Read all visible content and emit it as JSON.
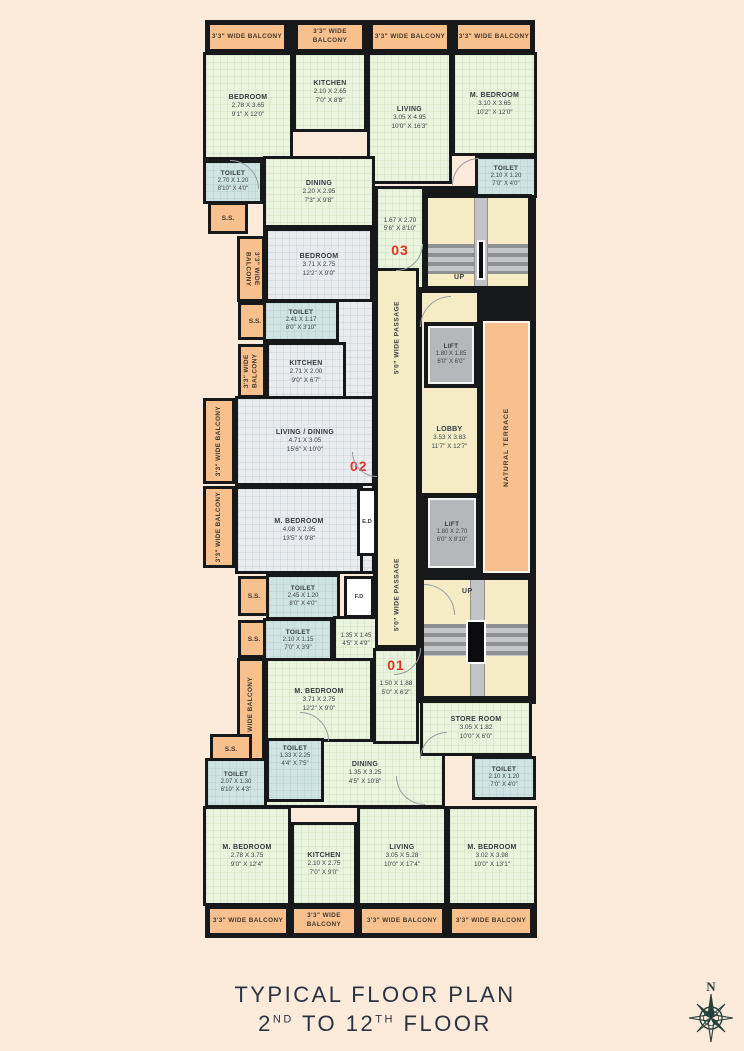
{
  "title": {
    "line1": "TYPICAL FLOOR PLAN",
    "l2n1": "2",
    "l2s1": "ND",
    "l2mid": " TO ",
    "l2n2": "12",
    "l2s2": "TH",
    "l2end": " FLOOR"
  },
  "compass": {
    "north": "N"
  },
  "colors": {
    "background": "#fceadb",
    "room_green": "#eaf3dd",
    "room_gray": "#e9ecef",
    "toilet_blue": "#cfe3e3",
    "balcony_orange": "#f7c08d",
    "core_cream": "#f5ecc6",
    "lift_gray": "#b6b7ba",
    "wall_black": "#17181a",
    "unit_number_red": "#e23428"
  },
  "labels": {
    "up": "UP",
    "ss": "S.S.",
    "ed": "E.D",
    "fd": "F.D",
    "passage": "5'0\" WIDE PASSAGE",
    "balcony": "3'3\" WIDE BALCONY",
    "natural_terrace": "NATURAL TERRACE"
  },
  "unit_numbers": {
    "u1": "01",
    "u2": "02",
    "u3": "03"
  },
  "rooms": {
    "t_bedroom": {
      "name": "BEDROOM",
      "m": "2.78 X 3.65",
      "ft": "9'1\" X 12'0\""
    },
    "t_kitchen": {
      "name": "KITCHEN",
      "m": "2.10 X 2.65",
      "ft": "7'0\" X 8'8\""
    },
    "t_living": {
      "name": "LIVING",
      "m": "3.05 X 4.95",
      "ft": "10'0\" X 16'3\""
    },
    "t_mbedroom": {
      "name": "M. BEDROOM",
      "m": "3.10 X 3.65",
      "ft": "10'2\" X 12'0\""
    },
    "t_toilet_l": {
      "name": "TOILET",
      "m": "2.70 X 1.20",
      "ft": "8'10\" X 4'0\""
    },
    "t_toilet_r": {
      "name": "TOILET",
      "m": "2.10 X 1.20",
      "ft": "7'0\" X 4'0\""
    },
    "t_dining": {
      "name": "DINING",
      "m": "2.20 X 2.95",
      "ft": "7'3\" X 9'8\""
    },
    "foyer3": {
      "m": "1.67 X 2.70",
      "ft": "5'6\" X 8'10\""
    },
    "u3_bedroom": {
      "name": "BEDROOM",
      "m": "3.71 X 2.75",
      "ft": "12'2\" X 9'0\""
    },
    "u3_toilet": {
      "name": "TOILET",
      "m": "2.41 X 1.17",
      "ft": "8'0\" X 3'10\""
    },
    "u3_kitchen": {
      "name": "KITCHEN",
      "m": "2.71 X 2.00",
      "ft": "9'0\" X 6'7\""
    },
    "u2_livdin": {
      "name": "LIVING / DINING",
      "m": "4.71 X 3.05",
      "ft": "15'6\" X 10'0\""
    },
    "u2_mbedroom": {
      "name": "M. BEDROOM",
      "m": "4.08 X 2.95",
      "ft": "13'5\" X 9'8\""
    },
    "u2_toilet1": {
      "name": "TOILET",
      "m": "2.45 X 1.20",
      "ft": "8'0\" X 4'0\""
    },
    "u2_toilet2": {
      "name": "TOILET",
      "m": "2.10 X 1.15",
      "ft": "7'0\" X 3'9\""
    },
    "pass135": {
      "m": "1.35 X 1.45",
      "ft": "4'5\" X 4'9\""
    },
    "u1_mbedroom_mid": {
      "name": "M. BEDROOM",
      "m": "3.71 X 2.75",
      "ft": "12'2\" X 9'0\""
    },
    "foyer1": {
      "m": "1.50 X 1.88",
      "ft": "5'0\" X 6'2\""
    },
    "lobby": {
      "name": "LOBBY",
      "m": "3.53 X 3.83",
      "ft": "11'7\" X 12'7\""
    },
    "lift_top": {
      "name": "LIFT",
      "m": "1.80 X 1.85",
      "ft": "6'0\" X 6'0\""
    },
    "lift_bottom": {
      "name": "LIFT",
      "m": "1.80 X 2.70",
      "ft": "6'0\" X 8'10\""
    },
    "store": {
      "name": "STORE ROOM",
      "m": "3.05 X 1.82",
      "ft": "10'0\" X 6'0\""
    },
    "br_toilet": {
      "name": "TOILET",
      "m": "2.10 X 1.20",
      "ft": "7'0\" X 4'0\""
    },
    "b_toilet1": {
      "name": "TOILET",
      "m": "1.33 X 2.25",
      "ft": "4'4\" X 7'5\""
    },
    "b_toilet2": {
      "name": "TOILET",
      "m": "2.07 X 1.30",
      "ft": "6'10\" X 4'3\""
    },
    "b_dining": {
      "name": "DINING",
      "m": "1.35 X 3.25",
      "ft": "4'5\" X 10'8\""
    },
    "b_mbedroom_l": {
      "name": "M. BEDROOM",
      "m": "2.78 X 3.75",
      "ft": "9'0\" X 12'4\""
    },
    "b_kitchen": {
      "name": "KITCHEN",
      "m": "2.10 X 2.75",
      "ft": "7'0\" X 9'0\""
    },
    "b_living": {
      "name": "LIVING",
      "m": "3.05 X 5.28",
      "ft": "10'0\" X 17'4\""
    },
    "b_mbedroom_r": {
      "name": "M. BEDROOM",
      "m": "3.02 X 3.98",
      "ft": "10'0\" X 13'1\""
    }
  }
}
